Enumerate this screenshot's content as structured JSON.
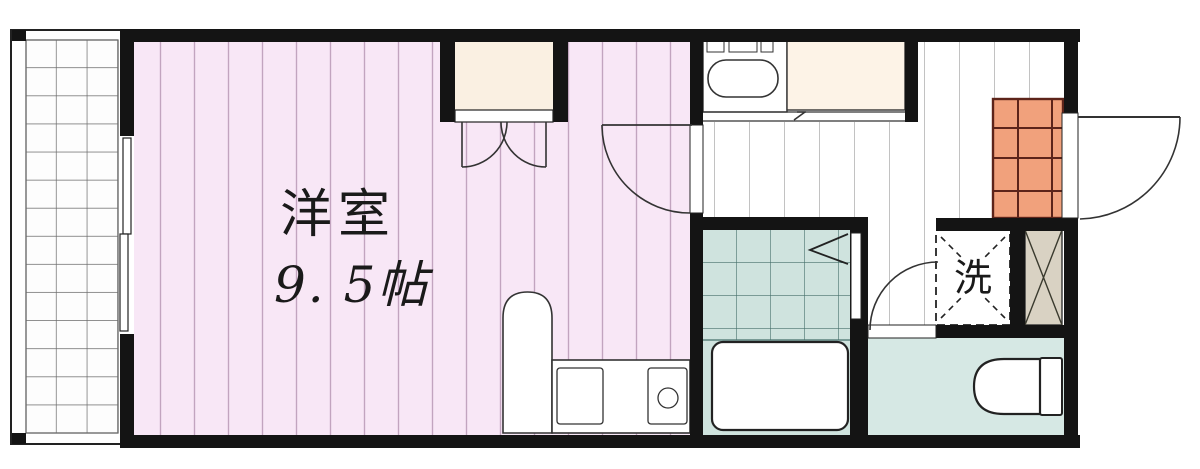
{
  "floorplan": {
    "kind": "apartment-1k-floor-plan",
    "labels": {
      "main_room_name": "洋室",
      "main_room_size": "9. 5帖",
      "washer": "洗"
    },
    "rooms": [
      {
        "name": "balcony"
      },
      {
        "name": "western-room",
        "label": "洋室 9. 5帖"
      },
      {
        "name": "closet"
      },
      {
        "name": "kitchen-hallway"
      },
      {
        "name": "unit-bath"
      },
      {
        "name": "laundry-space",
        "label": "洗"
      },
      {
        "name": "shoe-storage"
      },
      {
        "name": "entrance-genkan"
      },
      {
        "name": "toilet-room"
      }
    ],
    "colors": {
      "wall": "#141414",
      "room_pink": "#f8e7f6",
      "room_stripe": "#c2a4bf",
      "closet_cream": "#faf0e2",
      "counter_cream": "#fdf3e7",
      "genkan_orange": "#f1a17c",
      "genkan_line": "#5d241a",
      "bath_teal": "#cfe3de",
      "bath_line": "#46706b",
      "toilet_floor": "#d6e8e4",
      "storage_tan": "#d9d2c3",
      "hall_stripe": "#9a9a9a",
      "balcony_line": "#6a6a6a"
    }
  }
}
